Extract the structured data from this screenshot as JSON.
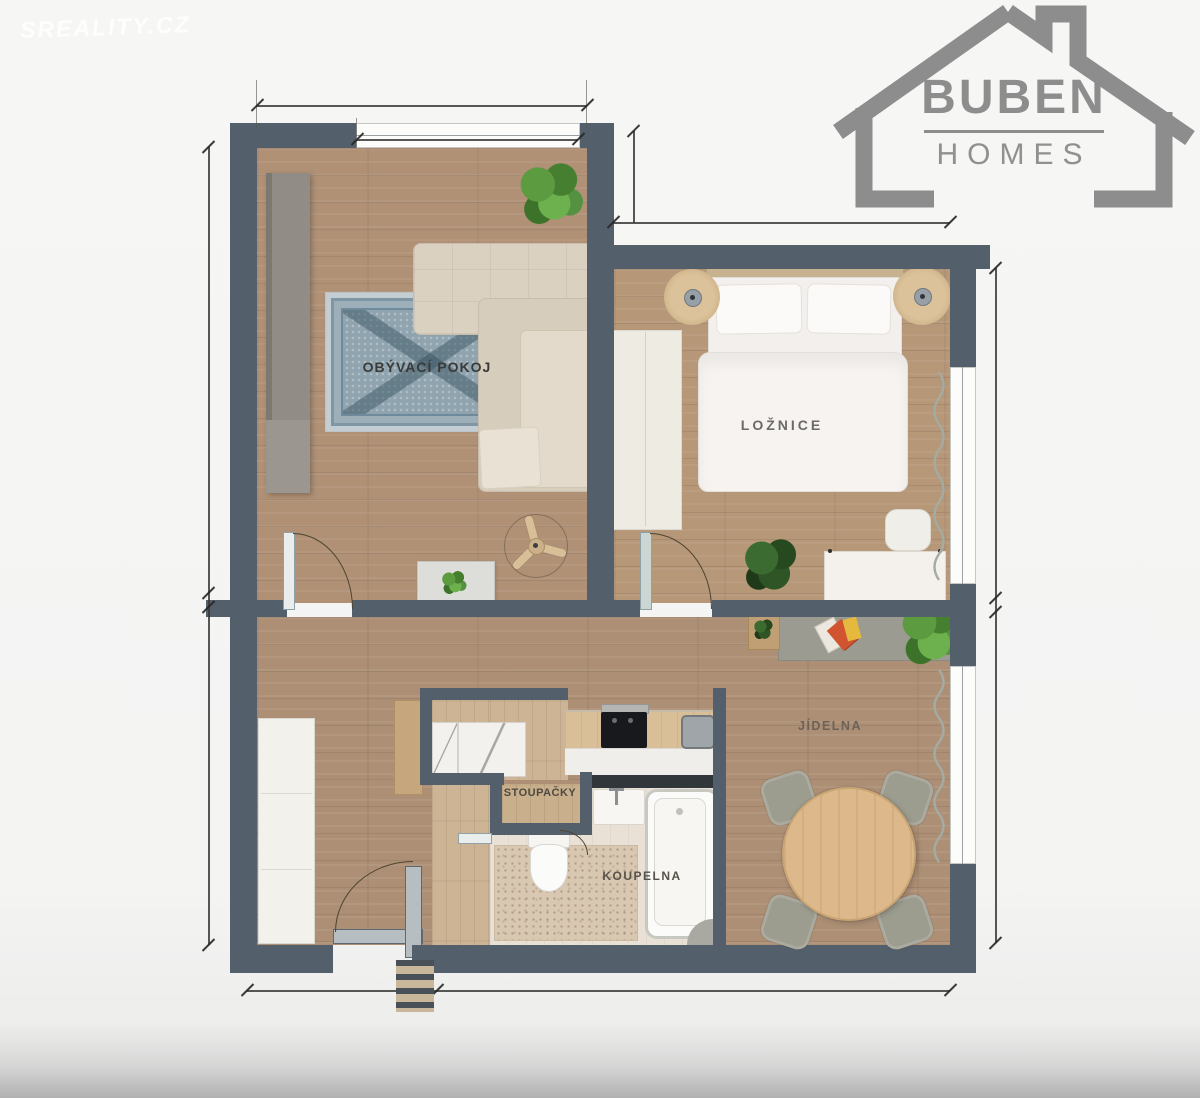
{
  "watermark": "SREALITY.CZ",
  "logo": {
    "title": "BUBEN",
    "subtitle": "HOMES"
  },
  "floor_plan": {
    "room_labels": {
      "living_room": "OBÝVACÍ POKOJ",
      "bedroom": "LOŽNICE",
      "risers": "STOUPAČKY",
      "bathroom": "KOUPELNA",
      "dining_room": "JÍDELNA"
    },
    "colors": {
      "wall": "#53606c",
      "wood_floor": "#b09176",
      "light_floor": "#ccb494",
      "bathroom_floor": "#e9e1d5",
      "rug_blue": "#90a4af",
      "sofa_cream": "#dbd1c1",
      "table_wood": "#dcb88a",
      "logo_gray": "#8d8d8d",
      "plant_green": "#5c9b40"
    }
  }
}
